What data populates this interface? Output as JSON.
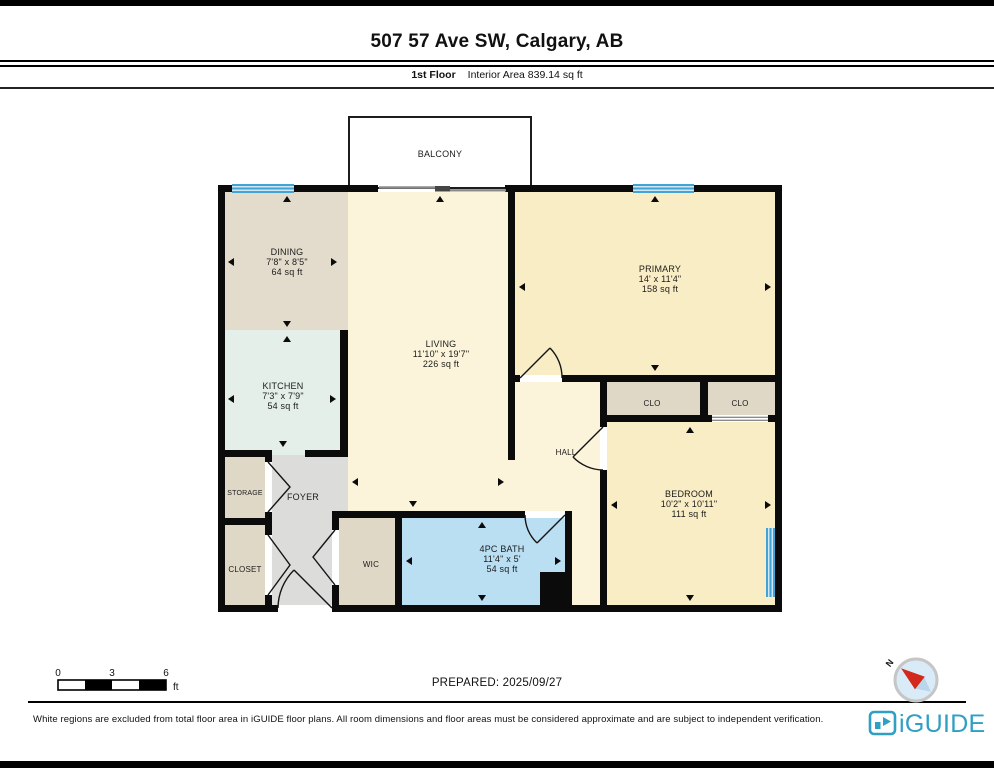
{
  "header": {
    "title": "507 57 Ave SW, Calgary, AB",
    "floor_label": "1st Floor",
    "area_label": "Interior Area 839.14 sq ft"
  },
  "rooms": {
    "balcony": {
      "name": "BALCONY"
    },
    "dining": {
      "name": "DINING",
      "dims": "7'8\" x 8'5\"",
      "area": "64 sq ft"
    },
    "kitchen": {
      "name": "KITCHEN",
      "dims": "7'3\" x 7'9\"",
      "area": "54 sq ft"
    },
    "living": {
      "name": "LIVING",
      "dims": "11'10\" x 19'7\"",
      "area": "226 sq ft"
    },
    "primary": {
      "name": "PRIMARY",
      "dims": "14' x 11'4\"",
      "area": "158 sq ft"
    },
    "bedroom": {
      "name": "BEDROOM",
      "dims": "10'2\" x 10'11\"",
      "area": "111 sq ft"
    },
    "bath": {
      "name": "4PC BATH",
      "dims": "11'4\" x 5'",
      "area": "54 sq ft"
    },
    "hall": {
      "name": "HALL"
    },
    "clo1": {
      "name": "CLO"
    },
    "clo2": {
      "name": "CLO"
    },
    "wic": {
      "name": "WIC"
    },
    "foyer": {
      "name": "FOYER"
    },
    "storage": {
      "name": "STORAGE"
    },
    "closet": {
      "name": "CLOSET"
    }
  },
  "footer": {
    "scale": {
      "t0": "0",
      "t1": "3",
      "t2": "6",
      "unit": "ft"
    },
    "prepared": "PREPARED: 2025/09/27",
    "compass_n": "N",
    "disclaimer": "White regions are excluded from total floor area in iGUIDE floor plans. All room dimensions and floor areas must be considered approximate and are subject to independent verification.",
    "brand": "iGUIDE"
  },
  "colors": {
    "wall": "#0b0b0b",
    "dining": "#e3dccc",
    "kitchen": "#e5efe9",
    "living": "#fbf4da",
    "primary": "#f9edc5",
    "closet_tan": "#e0d8c7",
    "foyer": "#dcdcda",
    "bath": "#badef2",
    "window": "#44a3d5",
    "balcony": "#ffffff",
    "brand_teal": "#2f9fc4",
    "compass_red": "#d3281c",
    "compass_fill": "#d9ebf7"
  }
}
